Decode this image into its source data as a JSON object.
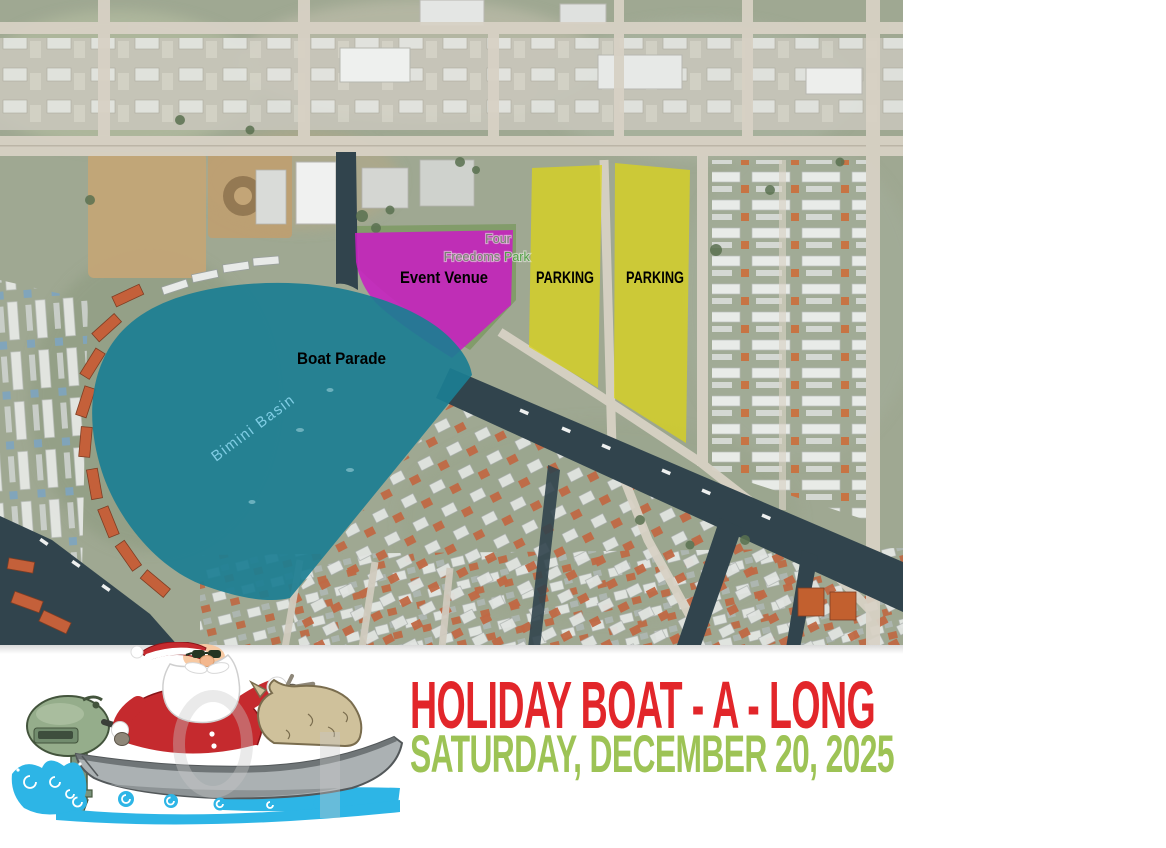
{
  "map": {
    "labels": {
      "event_venue": "Event Venue",
      "parking_left": "PARKING",
      "parking_right": "PARKING",
      "boat_parade": "Boat Parade",
      "basin": "Bimini Basin",
      "park_line1": "Four",
      "park_line2_word1": "Freedoms",
      "park_line2_word2": "Park"
    },
    "colors": {
      "boat_parade_overlay": "#1b7e93",
      "event_venue_overlay": "#c71fc0",
      "parking_overlay": "#d8d21e",
      "annotation_text": "#000000",
      "basin_label": "#7fcde4",
      "park_label_gray": "#75846f",
      "park_label_green": "#53a147"
    }
  },
  "footer": {
    "title": "HOLIDAY BOAT - A - LONG",
    "subtitle": "SATURDAY, DECEMBER 20, 2025",
    "colors": {
      "title": "#e2262a",
      "subtitle": "#9dc355"
    },
    "illustration": "santa-riding-motorboat"
  }
}
